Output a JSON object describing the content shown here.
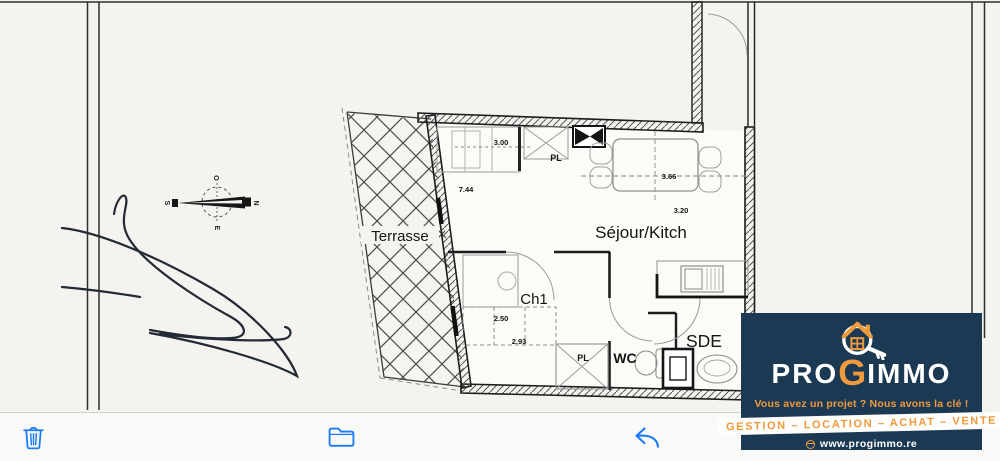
{
  "floor_plan": {
    "rooms": {
      "living": "Séjour/Kitch",
      "terrace": "Terrasse",
      "bedroom": "Ch1",
      "wc": "WC",
      "shower_room": "SDE",
      "closet_top": "PL",
      "closet_bottom": "PL"
    },
    "dimensions": {
      "kitchen_run": "3.00",
      "facade_length": "7.44",
      "living_width": "3.66",
      "living_depth": "3.20",
      "bedroom_width": "2.50",
      "bedroom_closet": "2.93"
    },
    "compass": {
      "top": "O",
      "right": "N",
      "bottom": "E",
      "left": "S"
    }
  },
  "watermark": {
    "brand": {
      "pro": "PRO",
      "g": "G",
      "immo": "IMMO"
    },
    "tagline": "Vous avez un projet ? Nous avons la clé !",
    "services": "GESTION – LOCATION – ACHAT – VENTE",
    "website": "www.progimmo.re",
    "icon": "house-key-icon",
    "colors": {
      "navy": "#1c3954",
      "orange": "#ee9a3d",
      "white": "#ffffff"
    }
  },
  "toolbar": {
    "accent": "#1c7bf6",
    "buttons": [
      {
        "name": "delete",
        "icon": "trash-icon"
      },
      {
        "name": "save-to-files",
        "icon": "folder-icon"
      },
      {
        "name": "reply",
        "icon": "reply-arrow-icon"
      }
    ]
  }
}
